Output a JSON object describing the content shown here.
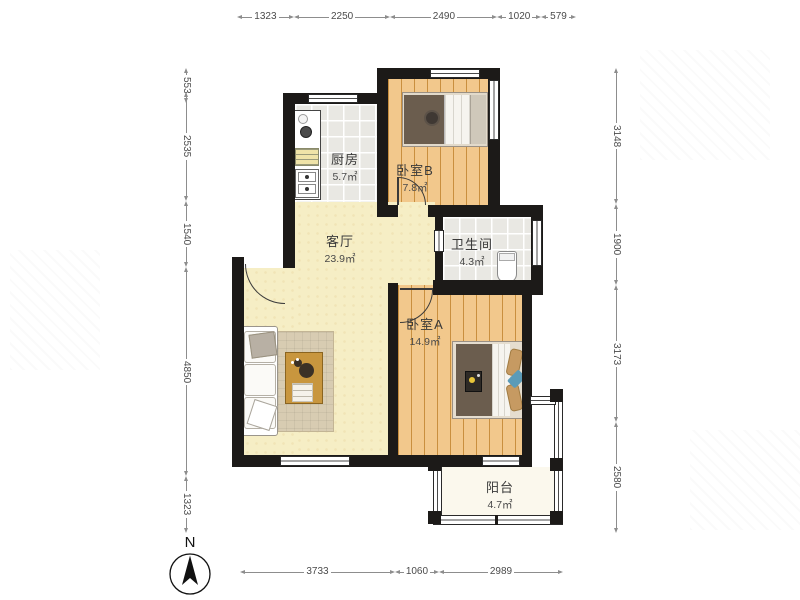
{
  "rooms": [
    {
      "id": "kitchen",
      "name": "厨房",
      "area": "5.7㎡"
    },
    {
      "id": "bedroomB",
      "name": "卧室B",
      "area": "7.8㎡"
    },
    {
      "id": "bathroom",
      "name": "卫生间",
      "area": "4.3㎡"
    },
    {
      "id": "living",
      "name": "客厅",
      "area": "23.9㎡"
    },
    {
      "id": "bedroomA",
      "name": "卧室A",
      "area": "14.9㎡"
    },
    {
      "id": "balcony",
      "name": "阳台",
      "area": "4.7㎡"
    }
  ],
  "dims": {
    "top": [
      {
        "label": "1323",
        "mm": 1323
      },
      {
        "label": "2250",
        "mm": 2250
      },
      {
        "label": "2490",
        "mm": 2490
      },
      {
        "label": "1020",
        "mm": 1020
      },
      {
        "label": "579",
        "mm": 579
      }
    ],
    "bottom": [
      {
        "label": "3733",
        "mm": 3733
      },
      {
        "label": "1060",
        "mm": 1060
      },
      {
        "label": "2989",
        "mm": 2989
      }
    ],
    "left": [
      {
        "label": "553",
        "mm": 553
      },
      {
        "label": "2535",
        "mm": 2535
      },
      {
        "label": "1540",
        "mm": 1540
      },
      {
        "label": "4850",
        "mm": 4850
      },
      {
        "label": "1323",
        "mm": 1323
      }
    ],
    "right": [
      {
        "label": "3148",
        "mm": 3148
      },
      {
        "label": "1900",
        "mm": 1900
      },
      {
        "label": "3173",
        "mm": 3173
      },
      {
        "label": "2580",
        "mm": 2580
      }
    ]
  },
  "compass": {
    "label": "N"
  },
  "colors": {
    "wall": "#1c1a18",
    "wood": "#f2c88c",
    "wood_line": "#c98f3e",
    "tile": "#e9e8e3",
    "living": "#f6eec5",
    "balcony_floor": "#fbf8ed",
    "dim": "#8d8d8d",
    "dim_text": "#4b4b4b",
    "label": "#3a3a3a",
    "rug": "#d8ccb2",
    "table": "#c8963e",
    "bed_dark": "#6b5d4e",
    "accent_blue": "#5b9bb8",
    "counter_yellow": "#efe3a8"
  }
}
